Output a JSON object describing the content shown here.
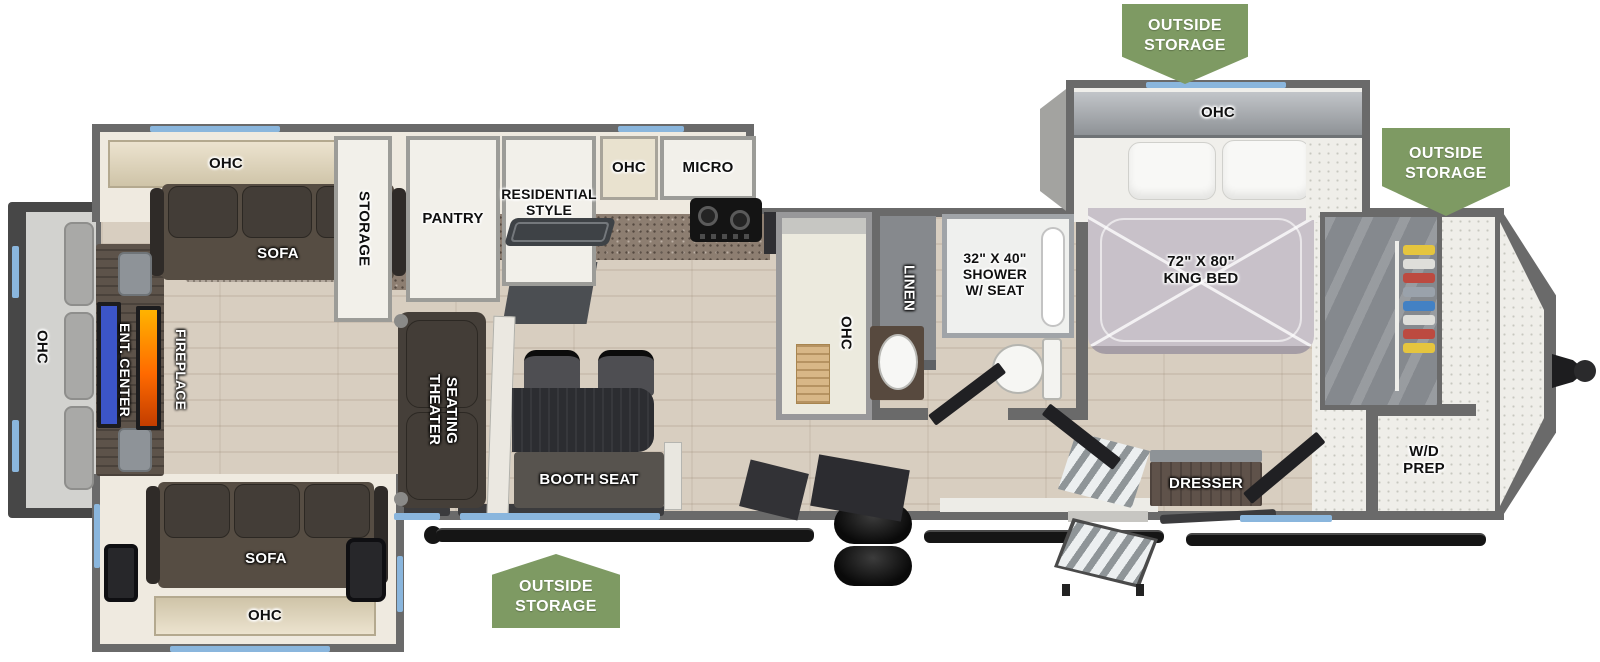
{
  "colors": {
    "badge_green": "#7e9a63",
    "wall_gray": "#6a6a6a",
    "window_blue": "#8ab6dd",
    "tv_blue": "#3c55c8",
    "fireplace_orange": "#ff8a00"
  },
  "badges": {
    "text": "OUTSIDE\nSTORAGE"
  },
  "rear": {
    "ohc": "OHC",
    "ent_center": "ENT. CENTER",
    "fireplace": "FIREPLACE"
  },
  "living": {
    "ohc_top": "OHC",
    "sofa_top": "SOFA",
    "storage": "STORAGE",
    "theater_seating": "THEATER\nSEATING",
    "booth_seat": "BOOTH SEAT",
    "sofa_bottom": "SOFA",
    "ohc_bottom": "OHC"
  },
  "kitchen": {
    "pantry": "PANTRY",
    "refer": "RESIDENTIAL\nSTYLE REFER",
    "ohc": "OHC",
    "micro": "MICRO",
    "island_ohc": "OHC"
  },
  "bathroom": {
    "linen": "LINEN",
    "shower": "32\" X 40\"\nSHOWER\nW/ SEAT"
  },
  "bedroom": {
    "ohc": "OHC",
    "king_bed": "72\" X 80\"\nKING BED",
    "dresser": "DRESSER"
  },
  "front": {
    "wd_prep": "W/D\nPREP"
  }
}
